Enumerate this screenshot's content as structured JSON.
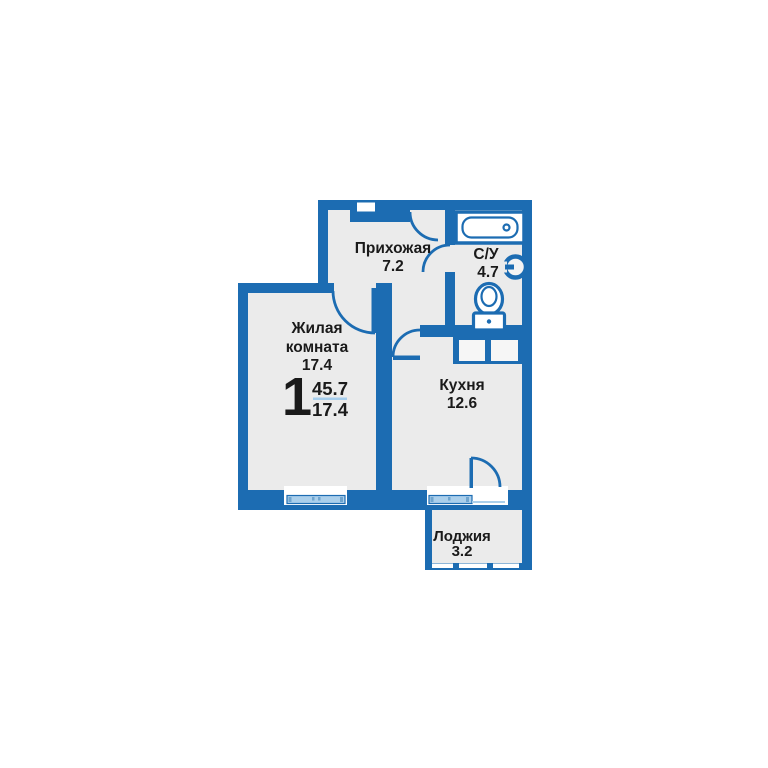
{
  "summary": {
    "rooms_count": "1",
    "total_area": "45.7",
    "living_area": "17.4"
  },
  "rooms": {
    "hallway": {
      "name": "Прихожая",
      "area": "7.2"
    },
    "bathroom": {
      "name": "С/У",
      "area": "4.7"
    },
    "living": {
      "name_line1": "Жилая",
      "name_line2": "комната",
      "area": "17.4"
    },
    "kitchen": {
      "name": "Кухня",
      "area": "12.6"
    },
    "loggia": {
      "name": "Лоджия",
      "area": "3.2"
    }
  },
  "colors": {
    "wall": "#1c6cb2",
    "floor": "#ebebeb",
    "glazing": "#aacfeb",
    "text": "#1a1a1a",
    "divider": "#a5cdec"
  }
}
